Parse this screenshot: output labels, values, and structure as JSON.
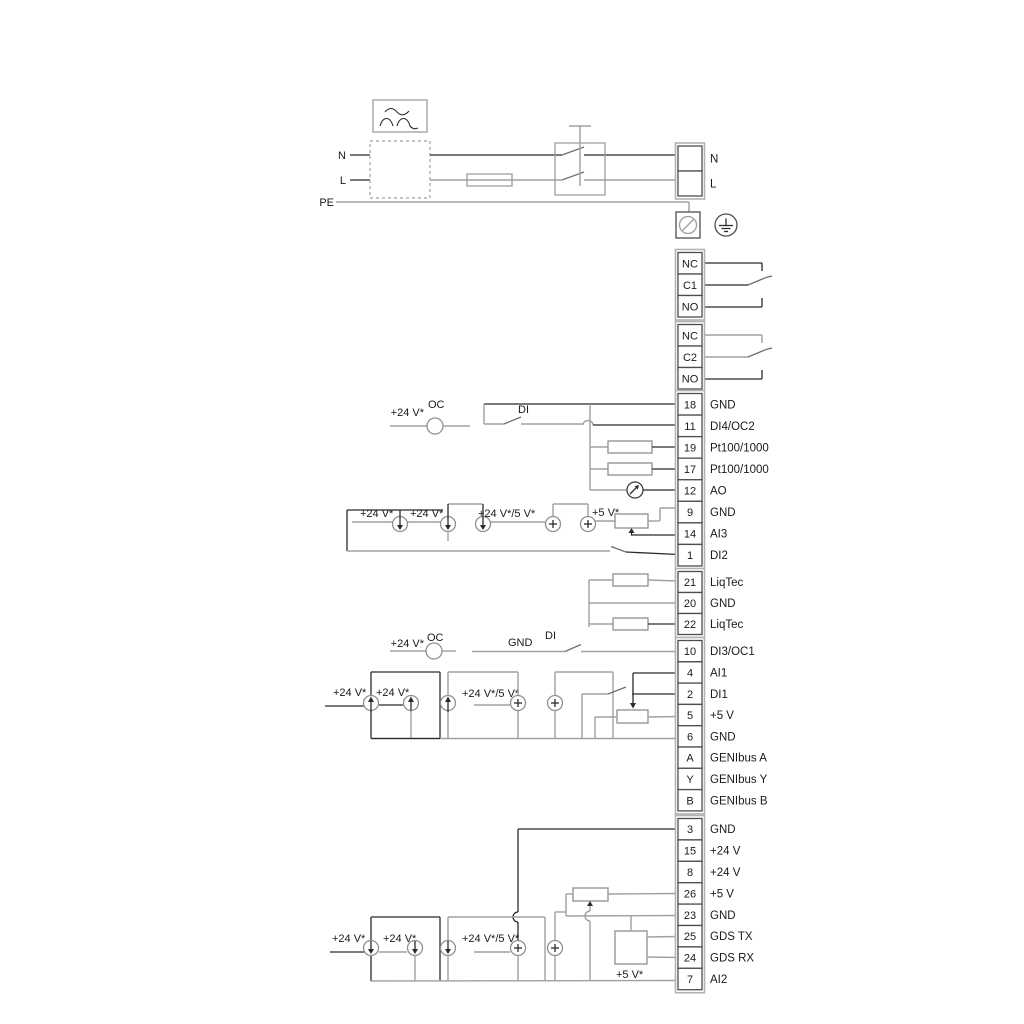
{
  "colors": {
    "wire_dark": "#2b2b2b",
    "wire_gray": "#a0a0a0",
    "symbol_gray": "#8f8f8f",
    "terminal_border": "#4d4d4d",
    "text": "#1a1a1a",
    "background": "#ffffff"
  },
  "power": {
    "n_left": "N",
    "l_left": "L",
    "pe": "PE"
  },
  "labels": {
    "v24": "+24 V*",
    "v24_5": "+24 V*/5 V*",
    "v5": "+5 V*",
    "oc": "OC",
    "di": "DI",
    "gnd": "GND"
  },
  "terminal_groups": [
    {
      "name": "mains-output",
      "cells": [
        {
          "id": "",
          "label": "N"
        },
        {
          "id": "",
          "label": "L"
        }
      ]
    },
    {
      "name": "relay-1",
      "cells": [
        {
          "id": "NC",
          "label": ""
        },
        {
          "id": "C1",
          "label": ""
        },
        {
          "id": "NO",
          "label": ""
        }
      ]
    },
    {
      "name": "relay-2",
      "cells": [
        {
          "id": "NC",
          "label": ""
        },
        {
          "id": "C2",
          "label": ""
        },
        {
          "id": "NO",
          "label": ""
        }
      ]
    },
    {
      "name": "io-a",
      "cells": [
        {
          "id": "18",
          "label": "GND"
        },
        {
          "id": "11",
          "label": "DI4/OC2"
        },
        {
          "id": "19",
          "label": "Pt100/1000"
        },
        {
          "id": "17",
          "label": "Pt100/1000"
        },
        {
          "id": "12",
          "label": "AO"
        },
        {
          "id": "9",
          "label": "GND"
        },
        {
          "id": "14",
          "label": "AI3"
        },
        {
          "id": "1",
          "label": "DI2"
        }
      ]
    },
    {
      "name": "liqtec",
      "cells": [
        {
          "id": "21",
          "label": "LiqTec"
        },
        {
          "id": "20",
          "label": "GND"
        },
        {
          "id": "22",
          "label": "LiqTec"
        }
      ]
    },
    {
      "name": "io-b",
      "cells": [
        {
          "id": "10",
          "label": "DI3/OC1"
        },
        {
          "id": "4",
          "label": "AI1"
        },
        {
          "id": "2",
          "label": "DI1"
        },
        {
          "id": "5",
          "label": "+5 V"
        },
        {
          "id": "6",
          "label": "GND"
        },
        {
          "id": "A",
          "label": "GENIbus A"
        },
        {
          "id": "Y",
          "label": "GENIbus Y"
        },
        {
          "id": "B",
          "label": "GENIbus B"
        }
      ]
    },
    {
      "name": "io-c",
      "cells": [
        {
          "id": "3",
          "label": "GND"
        },
        {
          "id": "15",
          "label": "+24 V"
        },
        {
          "id": "8",
          "label": "+24 V"
        },
        {
          "id": "26",
          "label": "+5 V"
        },
        {
          "id": "23",
          "label": "GND"
        },
        {
          "id": "25",
          "label": "GDS TX"
        },
        {
          "id": "24",
          "label": "GDS RX"
        },
        {
          "id": "7",
          "label": "AI2"
        }
      ]
    }
  ]
}
